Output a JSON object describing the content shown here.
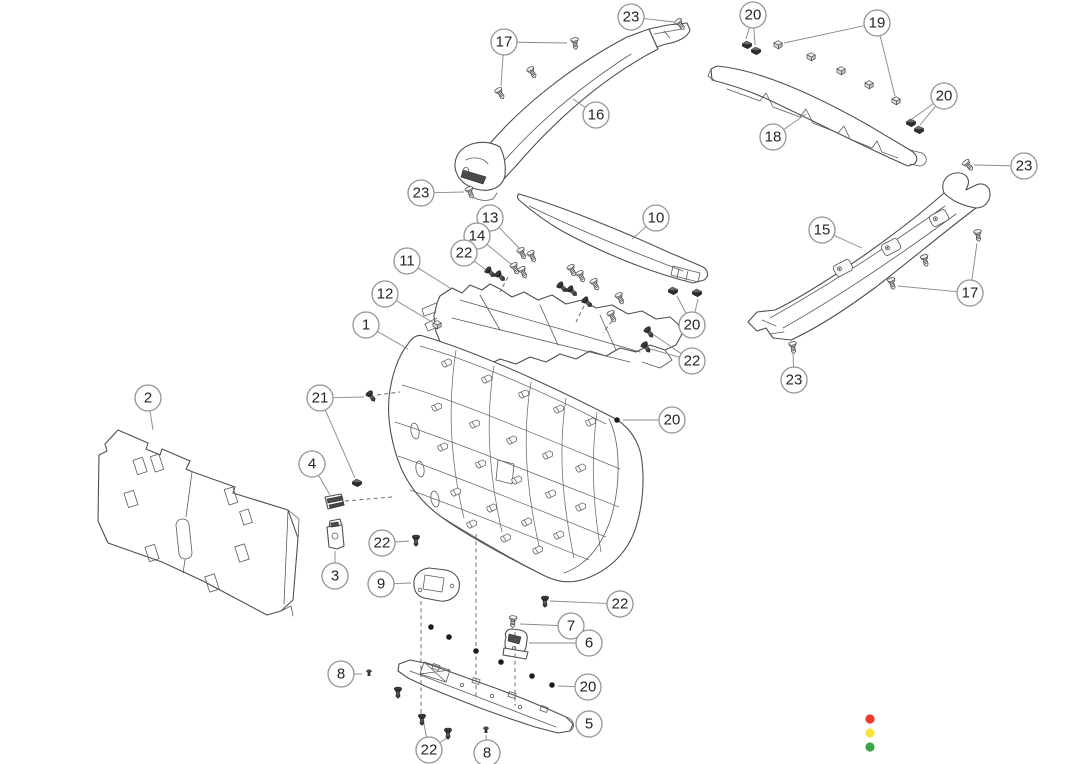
{
  "diagram": {
    "background": "#ffffff",
    "callout_style": {
      "radius": 13,
      "font_size": 15
    },
    "callouts": [
      {
        "label": "23",
        "x": 631,
        "y": 17,
        "t": [
          [
            674,
            22
          ]
        ]
      },
      {
        "label": "17",
        "x": 504,
        "y": 42,
        "t": [
          [
            567,
            43
          ],
          [
            501,
            86
          ]
        ]
      },
      {
        "label": "16",
        "x": 596,
        "y": 115,
        "t": [
          [
            573,
            99
          ]
        ]
      },
      {
        "label": "23",
        "x": 421,
        "y": 193,
        "t": [
          [
            464,
            192
          ]
        ]
      },
      {
        "label": "20",
        "x": 753,
        "y": 15,
        "t": [
          [
            746,
            39
          ],
          [
            755,
            45
          ]
        ]
      },
      {
        "label": "19",
        "x": 877,
        "y": 23,
        "t": [
          [
            784,
            43
          ],
          [
            895,
            96
          ]
        ]
      },
      {
        "label": "18",
        "x": 773,
        "y": 137,
        "t": [
          [
            806,
            114
          ]
        ]
      },
      {
        "label": "20",
        "x": 944,
        "y": 96,
        "t": [
          [
            912,
            119
          ],
          [
            920,
            125
          ]
        ]
      },
      {
        "label": "23",
        "x": 1024,
        "y": 166,
        "t": [
          [
            974,
            165
          ]
        ]
      },
      {
        "label": "10",
        "x": 656,
        "y": 218,
        "t": [
          [
            632,
            239
          ]
        ]
      },
      {
        "label": "13",
        "x": 490,
        "y": 218,
        "t": [
          [
            520,
            249
          ]
        ]
      },
      {
        "label": "14",
        "x": 477,
        "y": 236,
        "t": [
          [
            512,
            265
          ]
        ]
      },
      {
        "label": "22",
        "x": 464,
        "y": 253,
        "t": [
          [
            486,
            270
          ]
        ]
      },
      {
        "label": "11",
        "x": 407,
        "y": 261,
        "t": [
          [
            450,
            288
          ]
        ]
      },
      {
        "label": "12",
        "x": 385,
        "y": 294,
        "t": [
          [
            432,
            322
          ]
        ]
      },
      {
        "label": "1",
        "x": 366,
        "y": 325,
        "t": [
          [
            408,
            349
          ]
        ]
      },
      {
        "label": "15",
        "x": 822,
        "y": 230,
        "t": [
          [
            862,
            248
          ]
        ]
      },
      {
        "label": "17",
        "x": 970,
        "y": 293,
        "t": [
          [
            977,
            243
          ],
          [
            898,
            286
          ]
        ]
      },
      {
        "label": "23",
        "x": 794,
        "y": 380,
        "t": [
          [
            793,
            353
          ]
        ]
      },
      {
        "label": "20",
        "x": 692,
        "y": 325,
        "t": [
          [
            677,
            296
          ],
          [
            698,
            299
          ]
        ]
      },
      {
        "label": "22",
        "x": 692,
        "y": 361,
        "t": [
          [
            654,
            335
          ],
          [
            651,
            349
          ]
        ]
      },
      {
        "label": "2",
        "x": 148,
        "y": 398,
        "t": [
          [
            153,
            430
          ]
        ]
      },
      {
        "label": "21",
        "x": 320,
        "y": 398,
        "t": [
          [
            364,
            397
          ],
          [
            355,
            478
          ]
        ]
      },
      {
        "label": "4",
        "x": 312,
        "y": 464,
        "t": [
          [
            330,
            495
          ]
        ]
      },
      {
        "label": "3",
        "x": 335,
        "y": 576,
        "t": [
          [
            335,
            551
          ]
        ]
      },
      {
        "label": "20",
        "x": 672,
        "y": 420,
        "t": [
          [
            623,
            420
          ]
        ]
      },
      {
        "label": "22",
        "x": 382,
        "y": 543,
        "t": [
          [
            409,
            541
          ]
        ]
      },
      {
        "label": "9",
        "x": 381,
        "y": 584,
        "t": [
          [
            411,
            583
          ]
        ]
      },
      {
        "label": "22",
        "x": 620,
        "y": 604,
        "t": [
          [
            550,
            601
          ]
        ]
      },
      {
        "label": "7",
        "x": 571,
        "y": 626,
        "t": [
          [
            520,
            624
          ]
        ]
      },
      {
        "label": "6",
        "x": 589,
        "y": 643,
        "t": [
          [
            529,
            643
          ]
        ]
      },
      {
        "label": "8",
        "x": 341,
        "y": 674,
        "t": [
          [
            362,
            674
          ]
        ]
      },
      {
        "label": "20",
        "x": 588,
        "y": 687,
        "t": [
          [
            558,
            686
          ]
        ]
      },
      {
        "label": "5",
        "x": 589,
        "y": 724,
        "t": [
          [
            577,
            722
          ]
        ]
      },
      {
        "label": "22",
        "x": 429,
        "y": 750,
        "t": [
          [
            424,
            724
          ],
          [
            447,
            738
          ]
        ]
      },
      {
        "label": "8",
        "x": 487,
        "y": 753,
        "t": [
          [
            486,
            735
          ]
        ]
      }
    ],
    "fasteners": [
      {
        "g": "screw-light",
        "x": 680,
        "y": 24,
        "a": -35
      },
      {
        "g": "screw-light",
        "x": 575,
        "y": 43,
        "a": -8
      },
      {
        "g": "screw-light",
        "x": 532,
        "y": 72,
        "a": -30
      },
      {
        "g": "screw-light",
        "x": 500,
        "y": 93,
        "a": -30
      },
      {
        "g": "screw-light",
        "x": 470,
        "y": 192,
        "a": -20
      },
      {
        "g": "screw-light",
        "x": 968,
        "y": 165,
        "a": -40
      },
      {
        "g": "screw-light",
        "x": 978,
        "y": 235,
        "a": -8
      },
      {
        "g": "screw-light",
        "x": 925,
        "y": 260,
        "a": -15
      },
      {
        "g": "screw-light",
        "x": 892,
        "y": 283,
        "a": -15
      },
      {
        "g": "screw-light",
        "x": 793,
        "y": 347,
        "a": -8
      },
      {
        "g": "screw-light",
        "x": 522,
        "y": 253,
        "a": -25
      },
      {
        "g": "screw-light",
        "x": 532,
        "y": 256,
        "a": -25
      },
      {
        "g": "screw-light",
        "x": 515,
        "y": 268,
        "a": -25
      },
      {
        "g": "screw-light",
        "x": 523,
        "y": 272,
        "a": -25
      },
      {
        "g": "screw-light",
        "x": 572,
        "y": 270,
        "a": -25
      },
      {
        "g": "screw-light",
        "x": 581,
        "y": 276,
        "a": -25
      },
      {
        "g": "screw-light",
        "x": 595,
        "y": 284,
        "a": -25
      },
      {
        "g": "screw-light",
        "x": 620,
        "y": 298,
        "a": -25
      },
      {
        "g": "screw-light",
        "x": 612,
        "y": 316,
        "a": -25
      },
      {
        "g": "screw-light",
        "x": 513,
        "y": 621,
        "a": 4
      },
      {
        "g": "screw-dark",
        "x": 490,
        "y": 272,
        "a": -45
      },
      {
        "g": "screw-dark",
        "x": 500,
        "y": 276,
        "a": -45
      },
      {
        "g": "screw-dark",
        "x": 562,
        "y": 287,
        "a": -45
      },
      {
        "g": "screw-dark",
        "x": 572,
        "y": 291,
        "a": -45
      },
      {
        "g": "screw-dark",
        "x": 587,
        "y": 302,
        "a": -45
      },
      {
        "g": "screw-dark",
        "x": 649,
        "y": 332,
        "a": -35
      },
      {
        "g": "screw-dark",
        "x": 646,
        "y": 347,
        "a": -35
      },
      {
        "g": "screw-dark",
        "x": 371,
        "y": 396,
        "a": -35
      },
      {
        "g": "screw-dark",
        "x": 416,
        "y": 540,
        "a": 0
      },
      {
        "g": "screw-dark",
        "x": 545,
        "y": 601,
        "a": 0
      },
      {
        "g": "screw-dark",
        "x": 422,
        "y": 719,
        "a": 0
      },
      {
        "g": "screw-dark",
        "x": 448,
        "y": 733,
        "a": 0
      },
      {
        "g": "screw-dark",
        "x": 398,
        "y": 692,
        "a": 0
      },
      {
        "g": "clip",
        "x": 747,
        "y": 45,
        "a": 0
      },
      {
        "g": "clip",
        "x": 756,
        "y": 51,
        "a": 0
      },
      {
        "g": "clip",
        "x": 911,
        "y": 123,
        "a": 0
      },
      {
        "g": "clip",
        "x": 919,
        "y": 130,
        "a": 0
      },
      {
        "g": "clip",
        "x": 673,
        "y": 291,
        "a": 0
      },
      {
        "g": "clip",
        "x": 697,
        "y": 293,
        "a": 0
      },
      {
        "g": "clip",
        "x": 357,
        "y": 483,
        "a": 0
      },
      {
        "g": "block",
        "x": 778,
        "y": 45,
        "a": 0
      },
      {
        "g": "block",
        "x": 811,
        "y": 57,
        "a": 0
      },
      {
        "g": "block",
        "x": 841,
        "y": 71,
        "a": 0
      },
      {
        "g": "block",
        "x": 869,
        "y": 85,
        "a": 0
      },
      {
        "g": "block",
        "x": 896,
        "y": 101,
        "a": 0
      },
      {
        "g": "block",
        "x": 437,
        "y": 325,
        "a": 0
      },
      {
        "g": "dot",
        "x": 617,
        "y": 420,
        "a": 0
      },
      {
        "g": "dot",
        "x": 431,
        "y": 627,
        "a": 0
      },
      {
        "g": "dot",
        "x": 449,
        "y": 637,
        "a": 0
      },
      {
        "g": "dot",
        "x": 476,
        "y": 651,
        "a": 0
      },
      {
        "g": "dot",
        "x": 501,
        "y": 662,
        "a": 0
      },
      {
        "g": "dot",
        "x": 532,
        "y": 676,
        "a": 0
      },
      {
        "g": "dot",
        "x": 552,
        "y": 685,
        "a": 0
      },
      {
        "g": "pin",
        "x": 369,
        "y": 673,
        "a": 0
      },
      {
        "g": "pin",
        "x": 486,
        "y": 730,
        "a": 0
      }
    ],
    "dashed_lines": [
      [
        377,
        395,
        400,
        392
      ],
      [
        345,
        501,
        392,
        497
      ],
      [
        421,
        601,
        421,
        714
      ],
      [
        476,
        534,
        476,
        700
      ],
      [
        515,
        632,
        515,
        706
      ],
      [
        508,
        277,
        500,
        292
      ],
      [
        584,
        306,
        576,
        322
      ],
      [
        612,
        321,
        603,
        333
      ]
    ],
    "panel_mounts": [
      [
        447,
        363
      ],
      [
        487,
        379
      ],
      [
        524,
        394
      ],
      [
        559,
        409
      ],
      [
        591,
        422
      ],
      [
        437,
        407
      ],
      [
        475,
        424
      ],
      [
        512,
        440
      ],
      [
        548,
        455
      ],
      [
        581,
        468
      ],
      [
        443,
        447
      ],
      [
        481,
        464
      ],
      [
        517,
        480
      ],
      [
        551,
        494
      ],
      [
        581,
        507
      ],
      [
        456,
        492
      ],
      [
        492,
        508
      ],
      [
        527,
        522
      ],
      [
        559,
        535
      ],
      [
        472,
        524
      ],
      [
        506,
        538
      ],
      [
        538,
        550
      ]
    ],
    "panel_ovals": [
      [
        415,
        431
      ],
      [
        420,
        469
      ],
      [
        435,
        499
      ]
    ],
    "pillar_bosses": [
      [
        843,
        268
      ],
      [
        891,
        247
      ],
      [
        939,
        218
      ]
    ],
    "status_dots": {
      "x": 870,
      "y_start": 719,
      "spacing": 14,
      "radius": 4.6,
      "colors": [
        "#ee3a2c",
        "#fbe23b",
        "#3ca549"
      ],
      "names": [
        "red",
        "yellow",
        "green"
      ]
    }
  }
}
